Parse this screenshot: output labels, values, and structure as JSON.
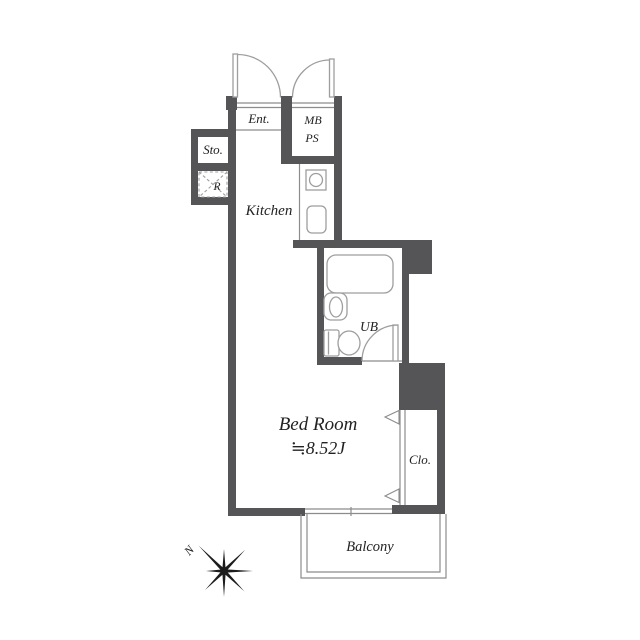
{
  "floorplan": {
    "rooms": {
      "entrance": {
        "label": "Ent."
      },
      "meter_box_pipe_space": {
        "line1": "MB",
        "line2": "PS"
      },
      "storage": {
        "label": "Sto."
      },
      "refrigerator": {
        "label": "R"
      },
      "kitchen": {
        "label": "Kitchen"
      },
      "unit_bath": {
        "label": "UB"
      },
      "bedroom": {
        "label": "Bed Room",
        "area": "≒8.52J"
      },
      "closet": {
        "label": "Clo."
      },
      "balcony": {
        "label": "Balcony"
      }
    },
    "compass": {
      "north": "N"
    },
    "colors": {
      "wall": "#555558",
      "fixture_line": "#9e9e9e",
      "structure_line": "#8c8c8c",
      "text": "#222222",
      "background": "#ffffff"
    }
  }
}
